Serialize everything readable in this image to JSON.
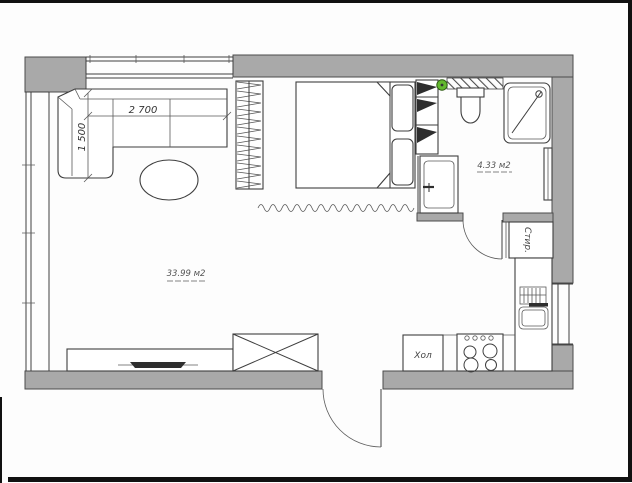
{
  "plan": {
    "type": "apartment-floor-plan",
    "labels": {
      "living_area": "33.99 м2",
      "bathroom_area": "4.33 м2",
      "fridge": "Хол",
      "washing_machine": "Стир.",
      "sofa_length_mm": "2 700",
      "sofa_depth_mm": "1 500"
    },
    "colors": {
      "wall_fill": "#a9a9a9",
      "wall_edge": "#4c4c4c",
      "line": "#3e3e3e",
      "marker_green": "#63b92e",
      "background": "#fdfdfd",
      "border": "#111111"
    },
    "rooms": [
      {
        "name": "living-room-with-kitchen",
        "area": "33.99 м2"
      },
      {
        "name": "bathroom",
        "area": "4.33 м2"
      }
    ],
    "symbols": [
      "corner-sofa",
      "coffee-table",
      "wardrobe",
      "curtain-divider",
      "double-bed",
      "shelf-unit",
      "toilet",
      "shower-cabin",
      "bathroom-sink",
      "towel-radiator",
      "washing-machine",
      "kitchen-counter",
      "kitchen-sink",
      "fridge",
      "stove",
      "tv-stand",
      "tv",
      "storage-cabinet",
      "entrance-door",
      "bathroom-door",
      "window-left",
      "window-top",
      "window-right",
      "green-marker",
      "demolition-hatch"
    ]
  }
}
